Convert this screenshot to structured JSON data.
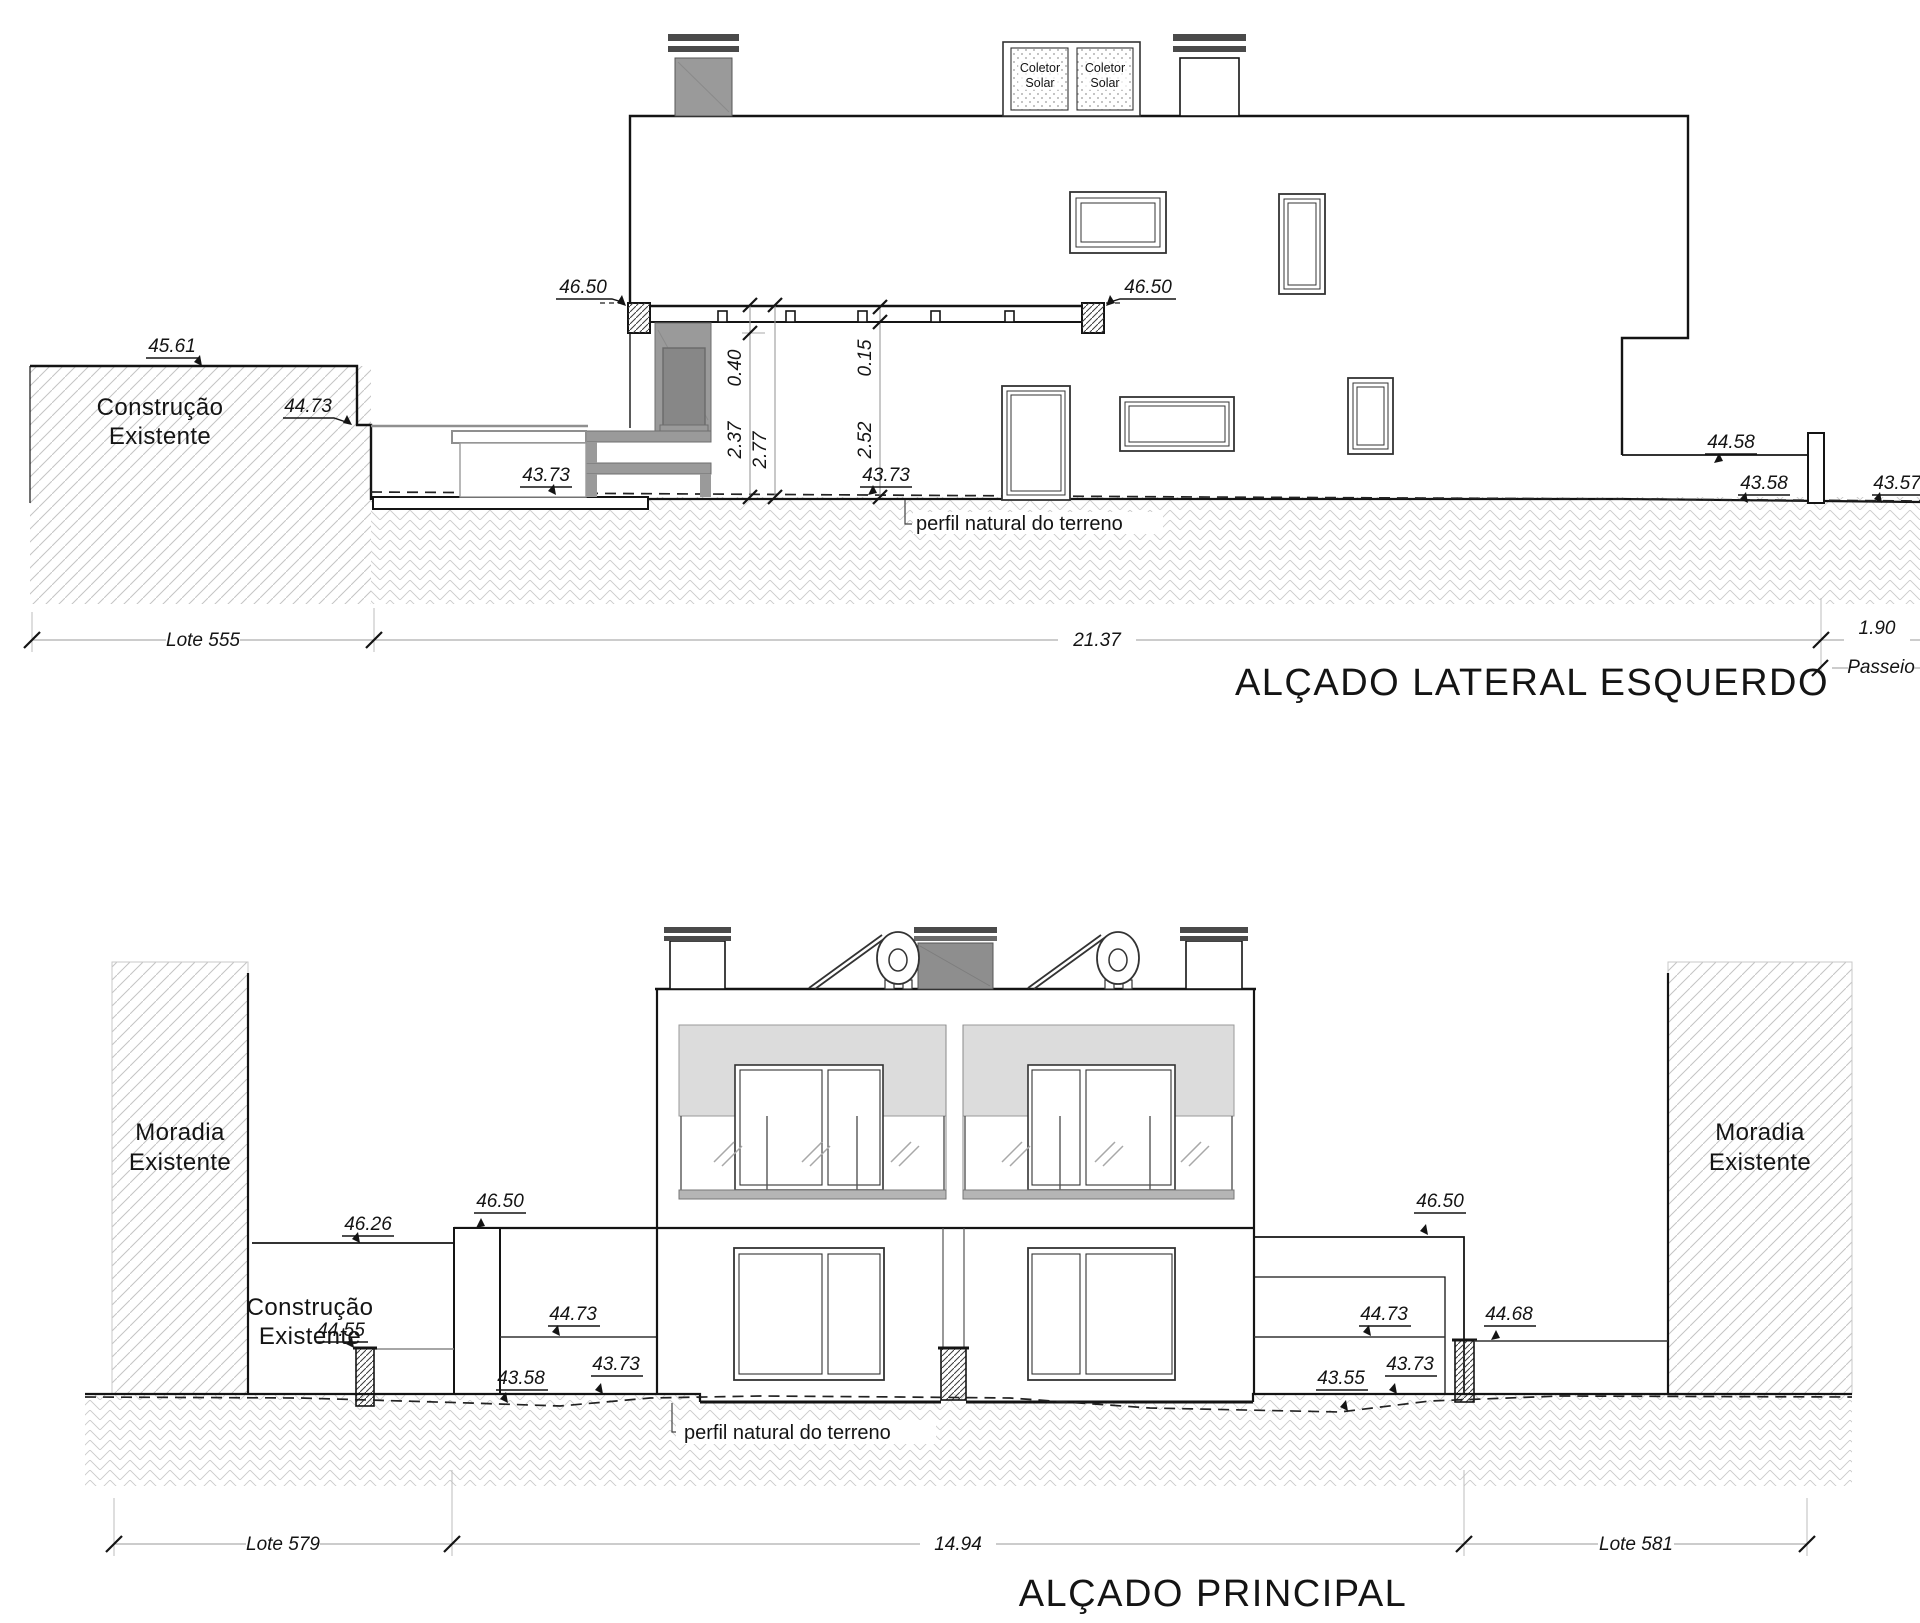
{
  "page": {
    "background": "#ffffff",
    "line_color": "#1a1a1a",
    "hatch_color": "#c8c8c8",
    "concrete_gray": "#9a9a9a",
    "band_gray": "#dcdcdc"
  },
  "levels": {
    "v4650": "46.50",
    "v4561": "45.61",
    "v4473": "44.73",
    "v4373": "43.73",
    "v4458": "44.58",
    "v4358": "43.58",
    "v4357": "43.57",
    "v4626": "46.26",
    "v4455": "44.55",
    "v4468": "44.68",
    "v4355": "43.55"
  },
  "dims": {
    "d040": "0.40",
    "d237": "2.37",
    "d277": "2.77",
    "d015": "0.15",
    "d252": "2.52",
    "d2137": "21.37",
    "d190": "1.90",
    "d1494": "14.94"
  },
  "lots": {
    "lote555": "Lote 555",
    "lote579": "Lote 579",
    "lote581": "Lote 581",
    "passeio": "Passeio"
  },
  "annotations": {
    "construcao": "Construção",
    "existente": "Existente",
    "moradia": "Moradia",
    "perfil": "perfil natural do terreno",
    "coletor": "Coletor",
    "solar": "Solar"
  },
  "titles": {
    "upper": "ALÇADO LATERAL ESQUERDO",
    "lower": "ALÇADO PRINCIPAL"
  }
}
